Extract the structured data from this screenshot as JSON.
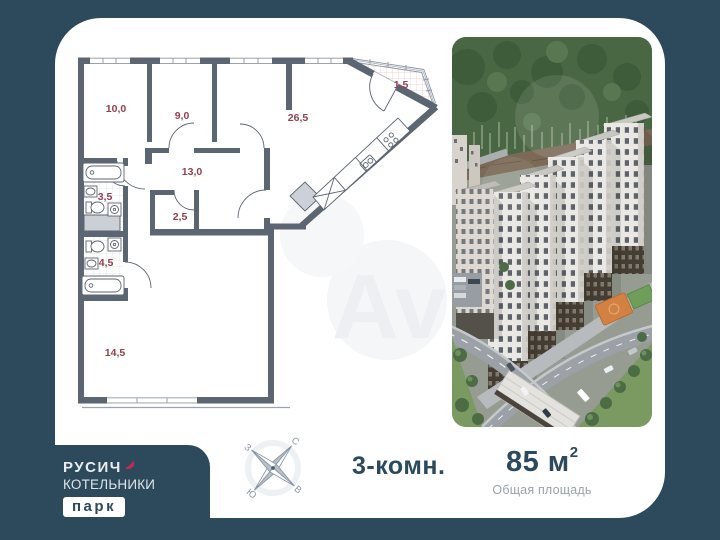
{
  "colors": {
    "background": "#2D4A5C",
    "card": "#FFFFFF",
    "wall": "#5C6672",
    "room_label": "#93404E",
    "logo_arrow": "#C22A52",
    "text_primary": "#2B4A5D",
    "text_muted": "#99A2AA"
  },
  "floor_plan": {
    "rooms": [
      {
        "name": "bedroom-1",
        "area": "10,0"
      },
      {
        "name": "bedroom-2",
        "area": "9,0"
      },
      {
        "name": "living-kitchen",
        "area": "26,5"
      },
      {
        "name": "balcony",
        "area": "1,5"
      },
      {
        "name": "hallway",
        "area": "13,0"
      },
      {
        "name": "bathroom-1",
        "area": "3,5"
      },
      {
        "name": "wardrobe",
        "area": "2,5"
      },
      {
        "name": "bathroom-2",
        "area": "4,5"
      },
      {
        "name": "bedroom-3",
        "area": "14,5"
      }
    ],
    "watermark": "Av"
  },
  "compass": {
    "north": "С",
    "east": "В",
    "south": "Ю",
    "west": "З"
  },
  "logo": {
    "brand": "РУСИЧ",
    "project": "КОТЕЛЬНИКИ",
    "suffix": "парк"
  },
  "summary": {
    "rooms": "3-комн.",
    "area": "85 м",
    "area_superscript": "2",
    "area_caption": "Общая площадь"
  }
}
